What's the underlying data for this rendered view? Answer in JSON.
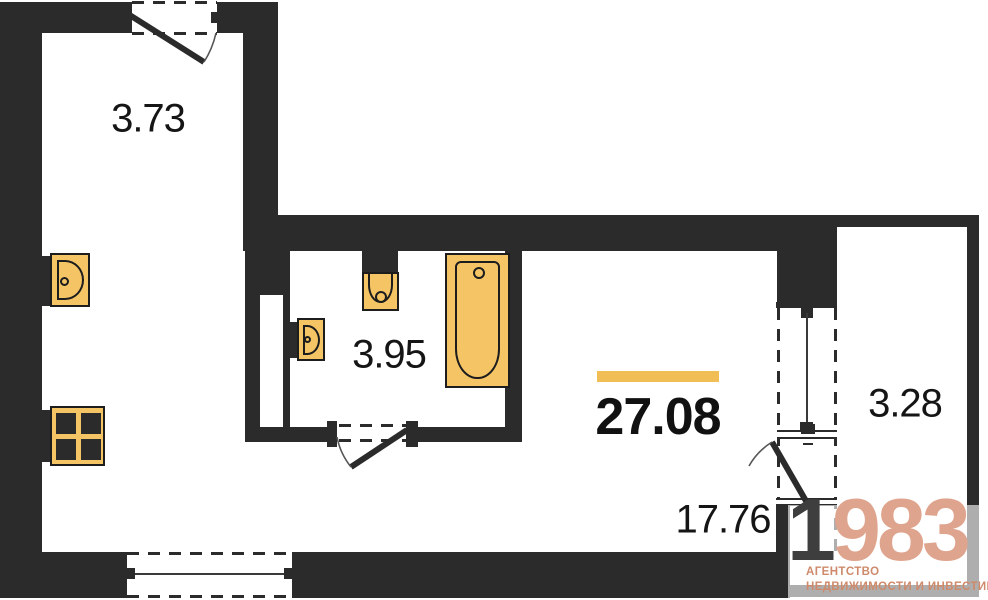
{
  "plan": {
    "title": "studio apartment floor plan",
    "total_area": "27.08",
    "rooms": [
      {
        "name": "hallway",
        "area": "3.73"
      },
      {
        "name": "bathroom",
        "area": "3.95"
      },
      {
        "name": "living-room",
        "area": "17.76"
      },
      {
        "name": "balcony",
        "area": "3.28"
      }
    ],
    "fixtures": [
      "kitchen-sink",
      "stove",
      "washbasin",
      "toilet",
      "bathtub"
    ]
  },
  "logo": {
    "year_prefix": "1",
    "year_suffix": "983",
    "line1": "АГЕНТСТВО",
    "line2": "НЕДВИЖИМОСТИ И ИНВЕСТИЦИЙ"
  },
  "colors": {
    "wall": "#2B2B2B",
    "fixture_fill": "#F5C565",
    "fixture_border": "#1D1D1D",
    "accent_bar": "#F1BE55",
    "logo_first_digit": "#3E3E3E",
    "logo_digits": "#DFA48E",
    "logo_text": "#CE8A6B"
  }
}
